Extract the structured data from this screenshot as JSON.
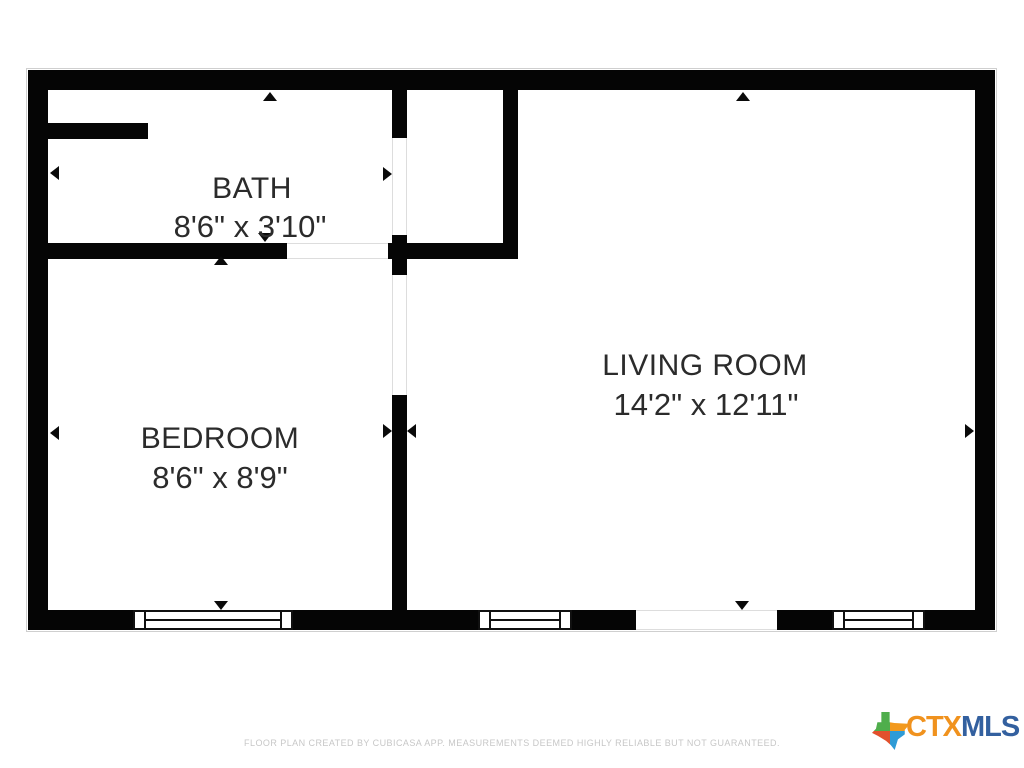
{
  "plan": {
    "type": "floor-plan",
    "rooms": [
      {
        "id": "bath",
        "label": "BATH",
        "dimensions": "8'6\" x 3'10\""
      },
      {
        "id": "bedroom",
        "label": "BEDROOM",
        "dimensions": "8'6\" x 8'9\""
      },
      {
        "id": "living-room",
        "label": "LIVING ROOM",
        "dimensions": "14'2\" x 12'11\""
      }
    ],
    "window_count": 3,
    "colors": {
      "wall": "#050505",
      "room_text": "#2b2b2b",
      "opening_line": "#dddddd"
    },
    "icons": {
      "measure_arrow": "small black triangle pointing outward to measured wall"
    }
  },
  "footer": {
    "disclaimer": "FLOOR PLAN CREATED BY CUBICASA APP. MEASUREMENTS DEEMED HIGHLY RELIABLE BUT NOT GUARANTEED.",
    "disclaimer_color": "#c7c7c7"
  },
  "logo": {
    "prefix": "CTX",
    "suffix": "MLS",
    "prefix_color": "#f0921e",
    "suffix_color": "#33609f",
    "icon": "texas-state-icon",
    "icon_colors": {
      "top_left": "#4fae4c",
      "top_right": "#f2991d",
      "bottom_left": "#e2512d",
      "bottom_right": "#2e9bd6"
    }
  }
}
